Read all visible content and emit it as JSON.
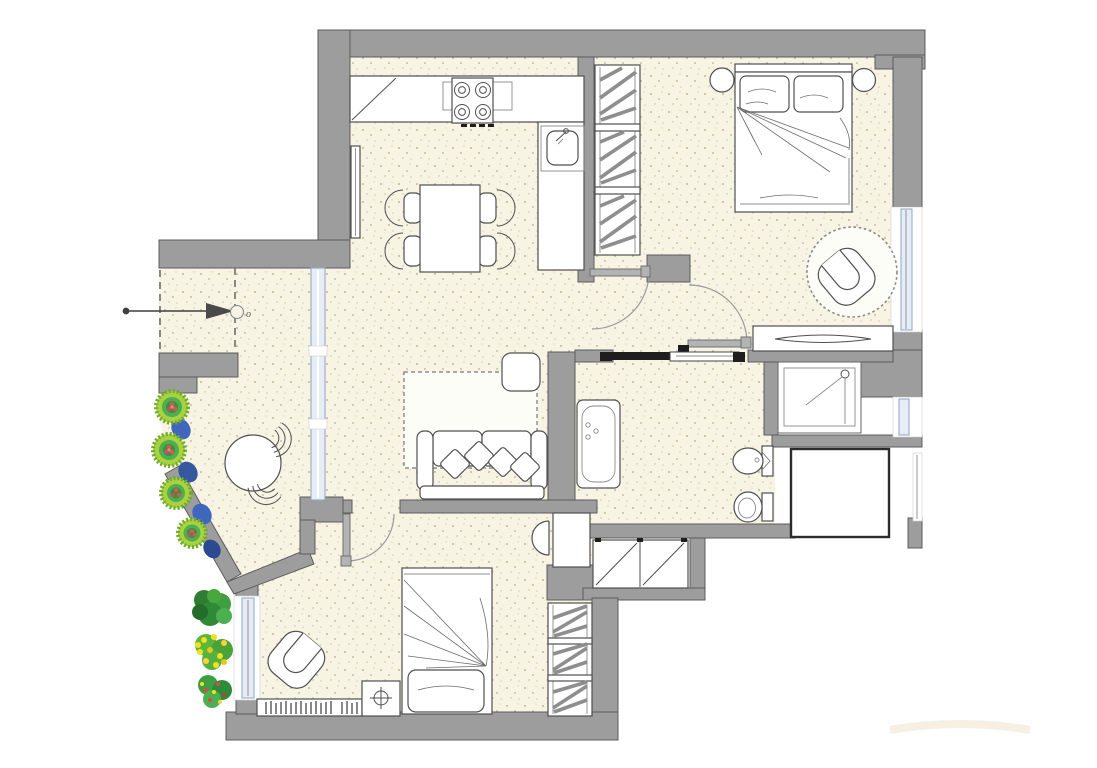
{
  "title": "apartment-floor-plan",
  "entry": {
    "label": "o"
  },
  "colors": {
    "wall": "#9d9d9d",
    "wall_stroke": "#5c5c5c",
    "floor": "#f8f4e4",
    "line": "#4f4f4f",
    "furniture_fill": "#ffffff",
    "window_fill": "#e7edf7",
    "window_stroke": "#8fa5c0",
    "door_leaf": "#b3b3b3",
    "track_dark": "#1e1e1e",
    "hatch": "#8e8e8e",
    "plant_green": "#4caf50",
    "plant_light": "#a8d23f",
    "plant_dark": "#2e7d32",
    "flower_blue": "#3f68bd",
    "flower_red": "#e0515d",
    "flower_yellow": "#f3e11f",
    "arrow": "#3f3f3f"
  },
  "rooms": [
    {
      "id": "kitchen-dining",
      "label": "kitchen and dining area"
    },
    {
      "id": "living-room",
      "label": "living room"
    },
    {
      "id": "bedroom-1",
      "label": "master bedroom"
    },
    {
      "id": "bedroom-2",
      "label": "second bedroom"
    },
    {
      "id": "bathroom",
      "label": "bathroom"
    },
    {
      "id": "hallway",
      "label": "hallway"
    },
    {
      "id": "entry-terrace",
      "label": "entry terrace with planting"
    }
  ],
  "furniture": [
    "kitchen-counter",
    "stove",
    "kitchen-sink",
    "radiator",
    "dining-table",
    "dining-chairs",
    "tall-wardrobe",
    "double-bed",
    "nightstands",
    "armchair",
    "round-rug",
    "dresser",
    "bathtub",
    "toilet",
    "bidet",
    "shower",
    "sliding-door",
    "hall-closet",
    "sofa",
    "side-table",
    "living-rug",
    "single-bed",
    "desk",
    "desk-chair",
    "bookshelf",
    "bedside-table",
    "terrace-table",
    "terrace-chairs",
    "flower-bed",
    "garden-plants",
    "entry-arrow"
  ]
}
